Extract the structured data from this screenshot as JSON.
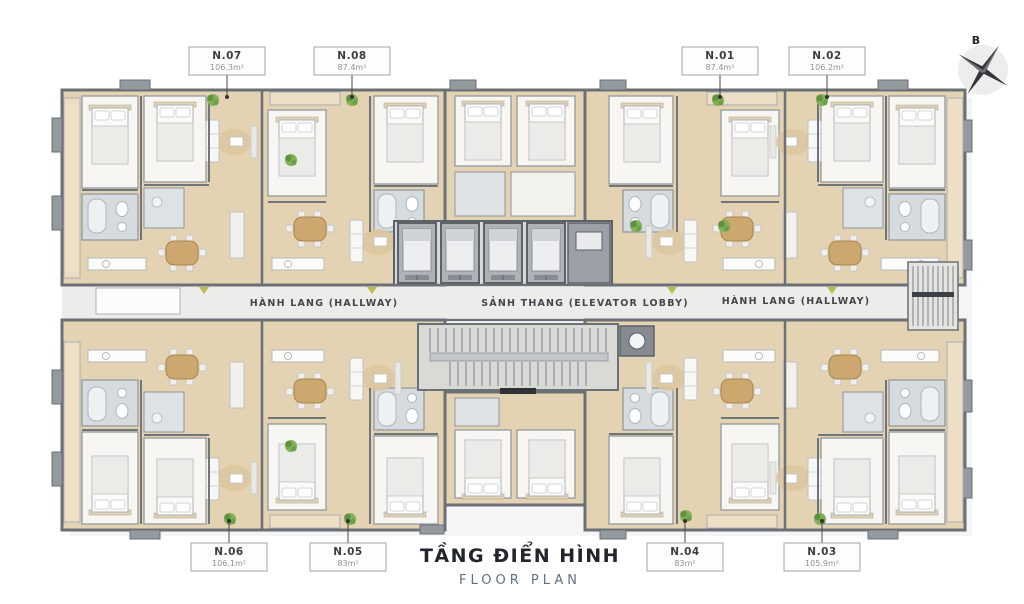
{
  "page": {
    "title_vi": "TẦNG ĐIỂN HÌNH",
    "title_en": "FLOOR PLAN"
  },
  "compass": {
    "label": "B",
    "icon": "compass-star-icon"
  },
  "corridor": {
    "left_label": "HÀNH LANG (HALLWAY)",
    "center_label": "SẢNH THANG (ELEVATOR LOBBY)",
    "right_label": "HÀNH LANG (HALLWAY)"
  },
  "units": [
    {
      "id": "N.07",
      "area": "106.3m²"
    },
    {
      "id": "N.08",
      "area": "87.4m²"
    },
    {
      "id": "N.01",
      "area": "87.4m²"
    },
    {
      "id": "N.02",
      "area": "106.2m²"
    },
    {
      "id": "N.06",
      "area": "106.1m²"
    },
    {
      "id": "N.05",
      "area": "83m²"
    },
    {
      "id": "N.04",
      "area": "83m²"
    },
    {
      "id": "N.03",
      "area": "105.9m²"
    }
  ],
  "colors": {
    "floor_wood": "#e3d3b2",
    "wall_gray": "#6b7077",
    "corridor_gray": "#ececea",
    "tile_gray": "#d5dbdf",
    "plant_green": "#7dab50",
    "accent_olive": "#b8bc4a",
    "title_dark": "#22252d",
    "subtitle_blue_gray": "#607182"
  }
}
